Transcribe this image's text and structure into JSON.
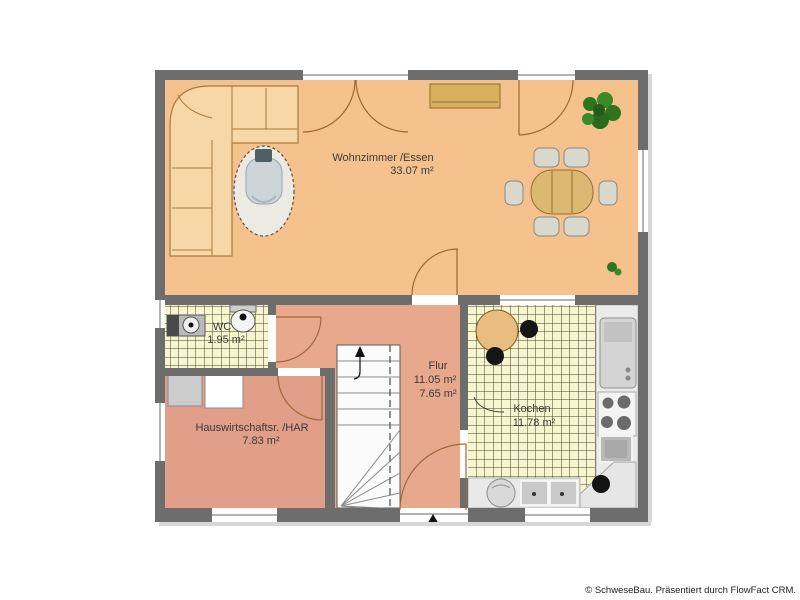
{
  "plan": {
    "rooms": [
      {
        "id": "living",
        "label": "Wohnzimmer /Essen",
        "area": "33.07 m²"
      },
      {
        "id": "wc",
        "label": "WC",
        "area": "1.95 m²"
      },
      {
        "id": "hall",
        "label": "Flur",
        "area": "11.05 m²",
        "area2": "7.65 m²"
      },
      {
        "id": "kitchen",
        "label": "Kochen",
        "area": "11.78 m²"
      },
      {
        "id": "utility",
        "label": "Hauswirtschaftsr. /HAR",
        "area": "7.83 m²"
      }
    ]
  },
  "footer": {
    "credit": "© SchweseBau. Präsentiert durch FlowFact CRM."
  },
  "colors": {
    "wall": "#6d6d6d",
    "living_floor": "#f5c18c",
    "hall_floor": "#e8a88c",
    "utility_floor": "#e19e88",
    "tile_floor": "#f7f6cf",
    "tile_grid": "#44432f",
    "wood": "#dcb873",
    "sofa": "#f8d7a6",
    "plant_green": "#2e741f",
    "counter_gray": "#ebebeb"
  }
}
